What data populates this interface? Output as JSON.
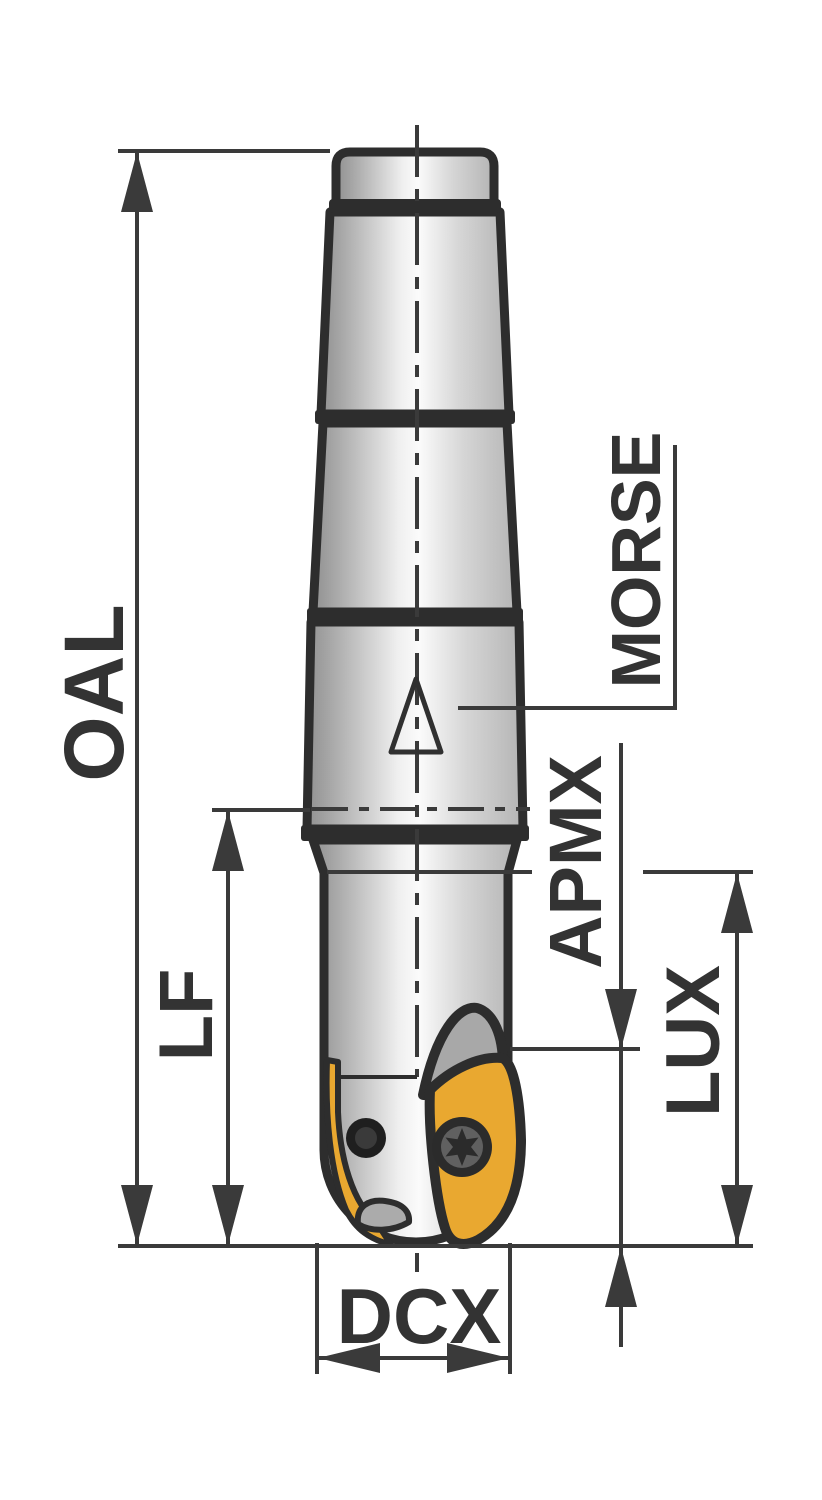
{
  "drawing": {
    "type": "tool-dimension-diagram",
    "subject": "ball-nose-end-mill-with-morse-taper-shank",
    "labels": {
      "oal": "OAL",
      "lf": "LF",
      "morse": "MORSE",
      "apmx": "APMX",
      "lux": "LUX",
      "dcx": "DCX"
    },
    "symbols": {
      "taper_mark": "triangle-icon",
      "screw": "torx-screw-icon",
      "coolant_hole": "dot-icon"
    },
    "colors": {
      "dimension_line": "#3a3a3a",
      "label_text": "#333333",
      "tool_outline": "#2d2d2d",
      "insert_yellow": "#E9A830",
      "body_light": "#fbfbfb",
      "body_dark": "#969696",
      "accent_gray": "#a8a8a8",
      "background": "#ffffff"
    }
  }
}
